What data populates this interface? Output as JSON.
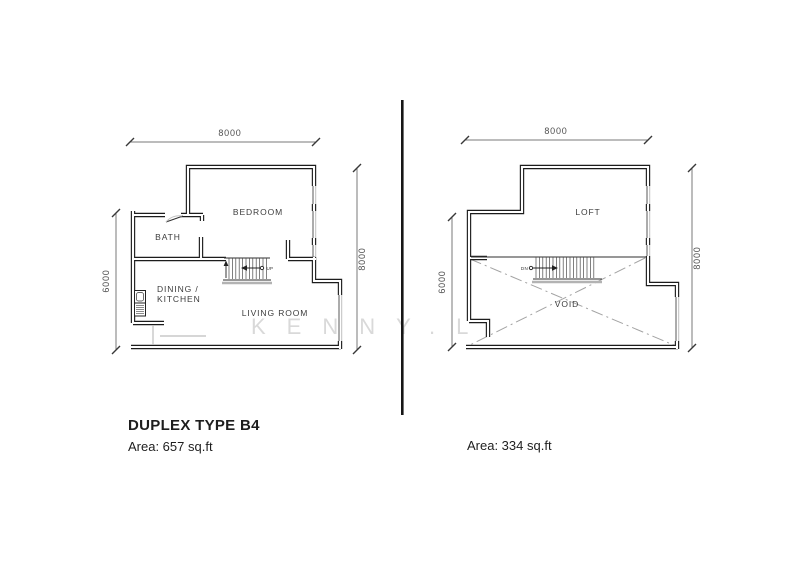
{
  "watermark": "KENNY.L",
  "title": "DUPLEX TYPE B4",
  "lower_plan": {
    "area": "Area: 657 sq.ft",
    "rooms": {
      "bedroom": "BEDROOM",
      "bath": "BATH",
      "dining_line1": "DINING /",
      "dining_line2": "KITCHEN",
      "living_room": "LIVING ROOM"
    },
    "stair_direction": "UP",
    "dims": {
      "top": "8000",
      "left": "6000",
      "right": "8000"
    }
  },
  "upper_plan": {
    "area": "Area: 334 sq.ft",
    "rooms": {
      "loft": "LOFT",
      "void": "VOID"
    },
    "stair_direction": "DN",
    "dims": {
      "top": "8000",
      "left": "6000",
      "right": "8000"
    }
  }
}
